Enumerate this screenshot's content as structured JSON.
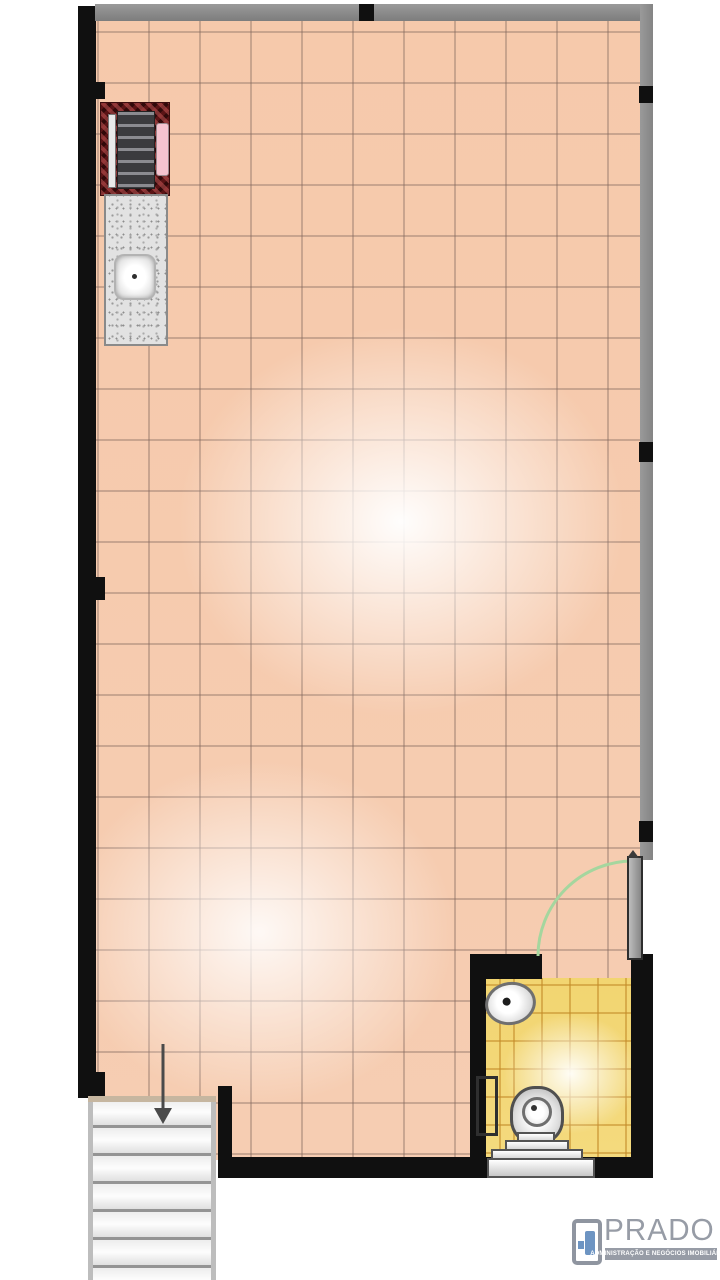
{
  "window": {
    "width": 720,
    "height": 1280,
    "background": "#ffffff"
  },
  "floorplan": {
    "type": "studio-floor-plan",
    "rooms": [
      {
        "name": "main-room",
        "floor": "ceramic-tile",
        "tile_color": "#f6cdb2",
        "grid_spacing_px": 51
      },
      {
        "name": "bathroom",
        "floor": "ceramic-tile",
        "tile_color": "#f2d571",
        "grid_spacing_px": 28
      },
      {
        "name": "stairwell",
        "floor": "steps",
        "step_spacing_px": 28,
        "direction": "down"
      }
    ],
    "fixtures": [
      {
        "name": "stove",
        "location": "top-left"
      },
      {
        "name": "kitchen-counter-with-sink",
        "location": "top-left"
      },
      {
        "name": "washbasin",
        "location": "bathroom-top-left"
      },
      {
        "name": "toilet",
        "location": "bathroom-bottom"
      },
      {
        "name": "bathroom-door",
        "swing": "into-main-room",
        "hinge": "right-wall"
      },
      {
        "name": "stairs-down-arrow",
        "location": "above-stairs"
      },
      {
        "name": "wall-niche",
        "location": "bathroom-left-wall"
      }
    ],
    "colors": {
      "wall_black": "#101010",
      "wall_gray": "#8e8e8e",
      "door_swing_green": "#a5d69e",
      "stair_line": "#949494",
      "stove_red": "#5a1416",
      "stove_pink": "#f6c3cf"
    }
  },
  "logo": {
    "brand": "PRADO",
    "tagline": "ADMINISTRAÇÃO E NEGÓCIOS IMOBILIÁRIOS",
    "text_color": "#979ca6",
    "icon_color": "#6d94c2",
    "icon": "door-logo-icon"
  }
}
